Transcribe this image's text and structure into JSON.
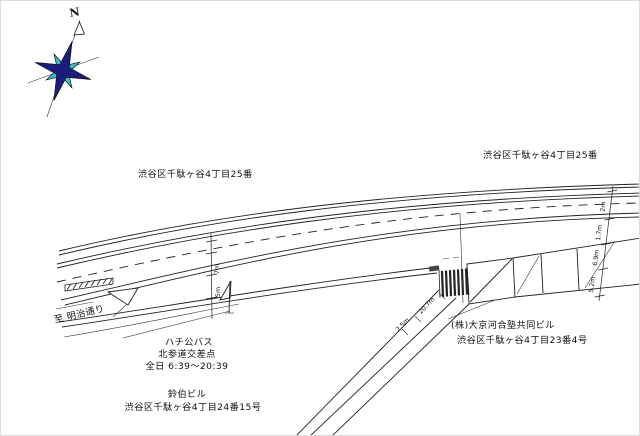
{
  "compass": {
    "north_label": "N"
  },
  "labels": {
    "block_upper_left": "渋谷区千駄ヶ谷4丁目25番",
    "block_upper_right": "渋谷区千駄ヶ谷4丁目25番",
    "to_meiji_dori": "至 明治通り",
    "bus_stop": {
      "line1": "ハチ公バス",
      "line2": "北参道交差点",
      "line3": "全日 6:39～20:39"
    },
    "building_bottom": {
      "name": "鈴伯ビル",
      "address": "渋谷区千駄ヶ谷4丁目24番15号"
    },
    "building_right": {
      "name": "(株)大京河合塾共同ビル",
      "address": "渋谷区千駄ヶ谷4丁目23番4号"
    }
  },
  "dimensions": {
    "right_edge_stack": [
      "2m",
      "1.7m",
      "6.9m",
      "5.2m"
    ],
    "road_section": [
      "7m",
      "5m"
    ],
    "side_street": [
      "20.7m",
      "2.5m"
    ]
  },
  "colors": {
    "compass_primary": "#1c1c7e",
    "compass_secondary": "#35c0c8",
    "ink": "#222222",
    "paper": "#ffffff"
  }
}
